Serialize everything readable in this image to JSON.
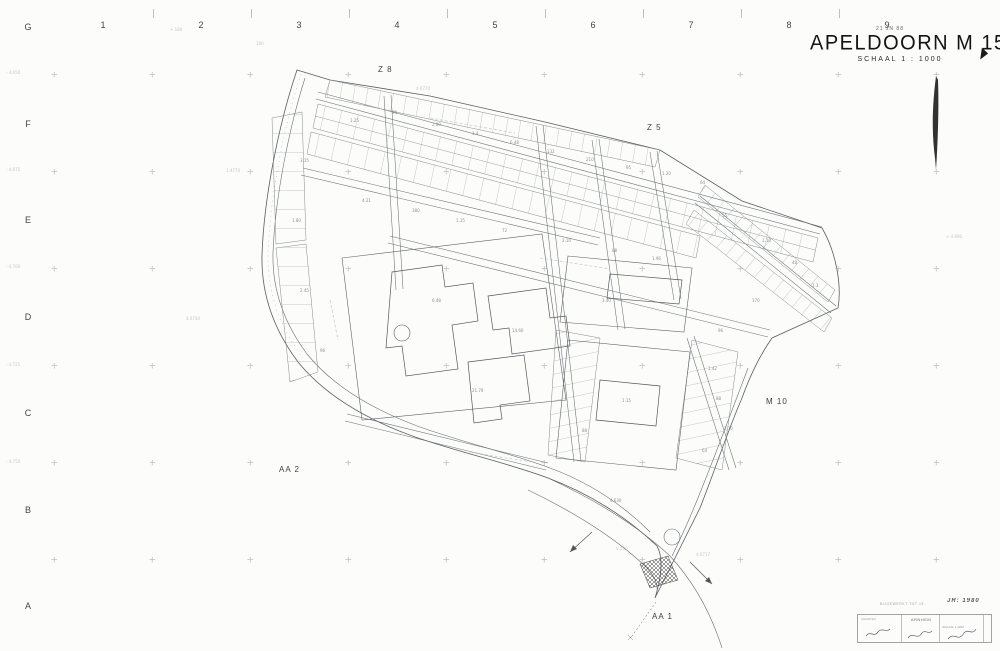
{
  "title": {
    "date_stamp": "21 JN 88",
    "name": "APELDOORN M 15",
    "scale": "SCHAAL   1 : 1000"
  },
  "grid": {
    "rows": [
      "G",
      "F",
      "E",
      "D",
      "C",
      "B",
      "A"
    ],
    "row_x": 21,
    "row_y0": 22,
    "row_step": 96.5,
    "columns": [
      "1",
      "2",
      "3",
      "4",
      "5",
      "6",
      "7",
      "8",
      "9"
    ],
    "col_y": 20,
    "col_x0": 96,
    "col_step": 98,
    "cross_x0": 55,
    "cross_xstep": 98,
    "cross_cols": 10,
    "cross_y0": 75,
    "cross_ystep": 97,
    "cross_rows": 6,
    "cross_glyph": "+"
  },
  "sheet_labels": [
    {
      "x": 378,
      "y": 65,
      "t": "Z 8"
    },
    {
      "x": 647,
      "y": 123,
      "t": "Z 5"
    },
    {
      "x": 766,
      "y": 397,
      "t": "M 10"
    },
    {
      "x": 279,
      "y": 465,
      "t": "AA 2"
    },
    {
      "x": 652,
      "y": 612,
      "t": "AA 1"
    }
  ],
  "coord_labels": [
    {
      "x": 6,
      "y": 70,
      "t": "- 4.650"
    },
    {
      "x": 6,
      "y": 167,
      "t": "- 4.675"
    },
    {
      "x": 6,
      "y": 264,
      "t": "- 4.700"
    },
    {
      "x": 6,
      "y": 362,
      "t": "- 4.725"
    },
    {
      "x": 6,
      "y": 459,
      "t": "- 4.750"
    },
    {
      "x": 170,
      "y": 27,
      "t": "+ 180"
    },
    {
      "x": 256,
      "y": 41,
      "t": "180"
    },
    {
      "x": 946,
      "y": 234,
      "t": "+ 4.690"
    },
    {
      "x": 416,
      "y": 86,
      "t": "4.6770"
    },
    {
      "x": 226,
      "y": 168,
      "t": "1.4770"
    },
    {
      "x": 186,
      "y": 316,
      "t": "4.6730"
    },
    {
      "x": 616,
      "y": 546,
      "t": "V 530"
    },
    {
      "x": 696,
      "y": 552,
      "t": "4.6717"
    }
  ],
  "parcel_labels": [
    {
      "x": 350,
      "y": 118,
      "t": "1.25"
    },
    {
      "x": 392,
      "y": 110,
      "t": "90"
    },
    {
      "x": 432,
      "y": 122,
      "t": "2.80"
    },
    {
      "x": 472,
      "y": 131,
      "t": "1.4"
    },
    {
      "x": 510,
      "y": 140,
      "t": "6.48"
    },
    {
      "x": 547,
      "y": 149,
      "t": "132"
    },
    {
      "x": 586,
      "y": 157,
      "t": "210"
    },
    {
      "x": 626,
      "y": 165,
      "t": "95"
    },
    {
      "x": 662,
      "y": 171,
      "t": "1.20"
    },
    {
      "x": 700,
      "y": 180,
      "t": "64"
    },
    {
      "x": 362,
      "y": 198,
      "t": "4.21"
    },
    {
      "x": 412,
      "y": 208,
      "t": "380"
    },
    {
      "x": 456,
      "y": 218,
      "t": "1.15"
    },
    {
      "x": 502,
      "y": 228,
      "t": "72"
    },
    {
      "x": 562,
      "y": 238,
      "t": "2.10"
    },
    {
      "x": 612,
      "y": 248,
      "t": "88"
    },
    {
      "x": 652,
      "y": 256,
      "t": "1.96"
    },
    {
      "x": 722,
      "y": 213,
      "t": "55"
    },
    {
      "x": 762,
      "y": 238,
      "t": "1.10"
    },
    {
      "x": 792,
      "y": 260,
      "t": "48"
    },
    {
      "x": 812,
      "y": 283,
      "t": "2.3"
    },
    {
      "x": 752,
      "y": 298,
      "t": "170"
    },
    {
      "x": 718,
      "y": 328,
      "t": "96"
    },
    {
      "x": 708,
      "y": 366,
      "t": "1.42"
    },
    {
      "x": 716,
      "y": 396,
      "t": "88"
    },
    {
      "x": 724,
      "y": 426,
      "t": "2.10"
    },
    {
      "x": 702,
      "y": 448,
      "t": "64"
    },
    {
      "x": 300,
      "y": 158,
      "t": "3.15"
    },
    {
      "x": 292,
      "y": 218,
      "t": "1.80"
    },
    {
      "x": 300,
      "y": 288,
      "t": "2.45"
    },
    {
      "x": 320,
      "y": 348,
      "t": "96"
    },
    {
      "x": 432,
      "y": 298,
      "t": "6.48"
    },
    {
      "x": 512,
      "y": 328,
      "t": "14.60"
    },
    {
      "x": 472,
      "y": 388,
      "t": "21.79"
    },
    {
      "x": 602,
      "y": 298,
      "t": "3.40"
    },
    {
      "x": 622,
      "y": 398,
      "t": "1.15"
    },
    {
      "x": 582,
      "y": 428,
      "t": "88"
    },
    {
      "x": 610,
      "y": 498,
      "t": "4.630"
    }
  ],
  "stamp": {
    "note": "BIJGEWERKT TOT 19..",
    "year": "JR: 1980",
    "office": "ARNHEM",
    "left_head": "GEMETEN",
    "right_head": "SCHAAL 1:1000"
  }
}
